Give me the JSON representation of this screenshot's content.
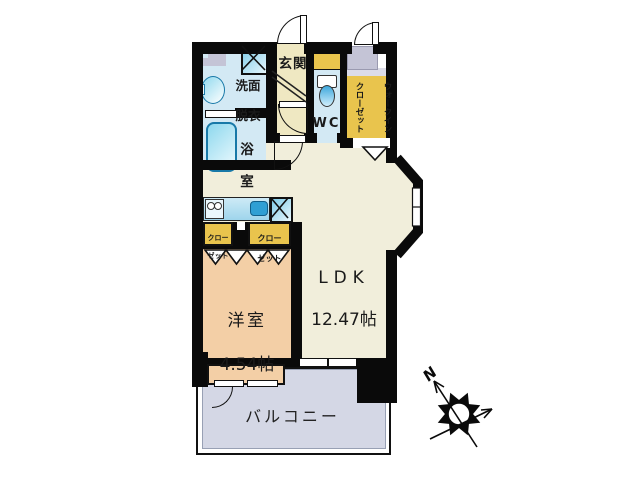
{
  "colors": {
    "wall": "#0a0a0a",
    "ldk": "#f1eedb",
    "hall": "#efe8c2",
    "wet": "#d3e9f4",
    "gold": "#e9c44d",
    "peach": "#f3cfa6",
    "balcony": "#d4d7e5",
    "graybox": "#c4c4d6",
    "fixture": "#1879a8"
  },
  "plan": {
    "entrance": {
      "label": "玄関"
    },
    "washroom": {
      "line1": "洗面",
      "line2": "脱衣"
    },
    "bathroom": {
      "line1": "浴",
      "line2": "室"
    },
    "toilet": {
      "label": "WC"
    },
    "walk_in_closet": {
      "line1": "ウォークイン",
      "line2": "クローゼット"
    },
    "closet_small_left": {
      "line1": "クロー",
      "line2": "ゼット"
    },
    "closet_small_right": {
      "line1": "クロー",
      "line2": "ゼット"
    },
    "ldk": {
      "label": "LDK",
      "area": "12.47帖"
    },
    "western_room": {
      "label": "洋室",
      "area": "4.54帖"
    },
    "balcony": {
      "label": "バルコニー"
    },
    "compass": {
      "north": "N"
    }
  }
}
